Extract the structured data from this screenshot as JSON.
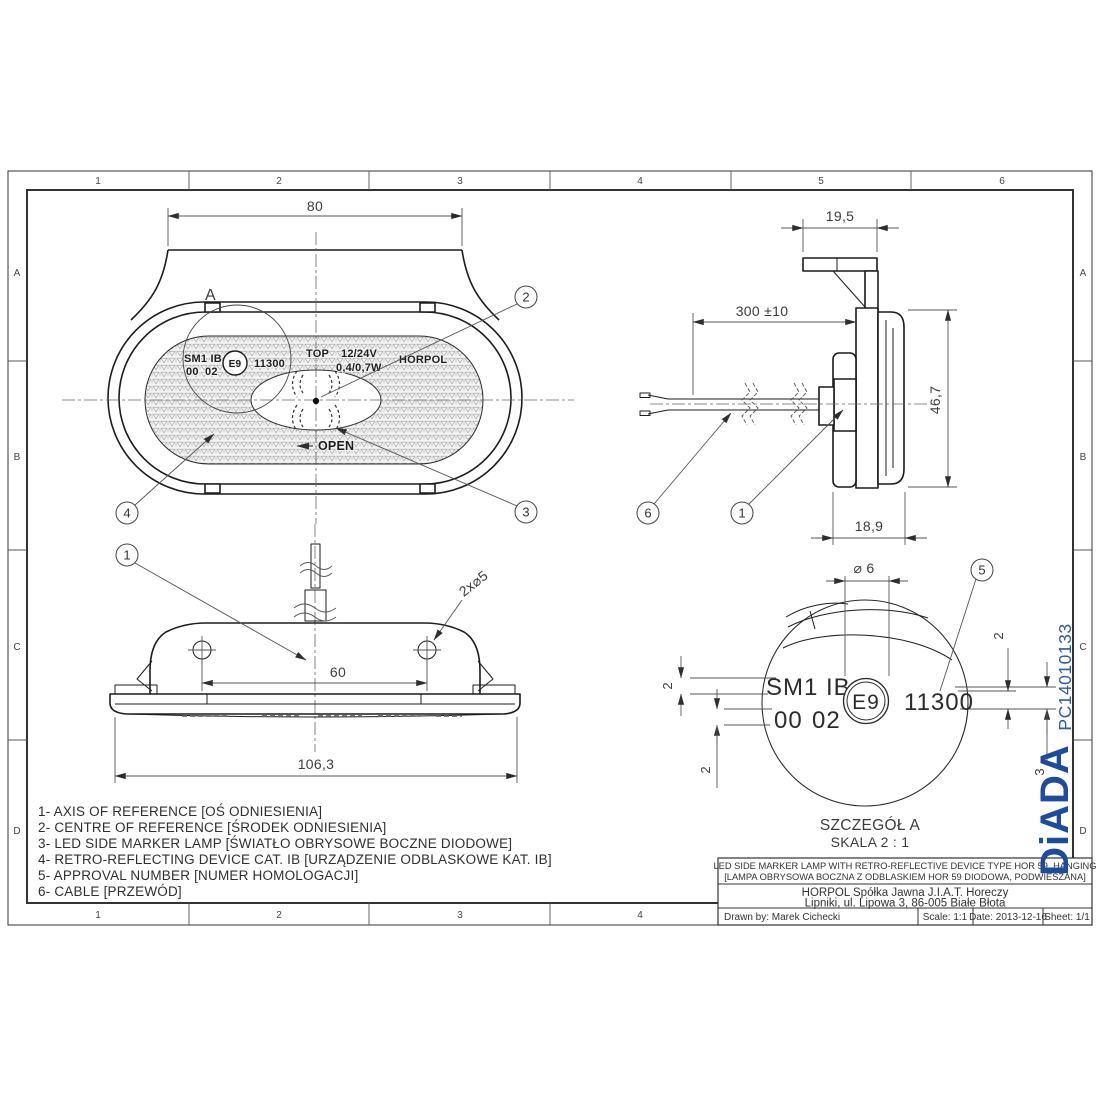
{
  "sheet": {
    "zones_top": [
      "1",
      "2",
      "3",
      "4",
      "5",
      "6"
    ],
    "zones_bottom": [
      "1",
      "2",
      "3",
      "4"
    ],
    "zones_left": [
      "A",
      "B",
      "C",
      "D"
    ],
    "zones_right": [
      "A",
      "B",
      "C",
      "D"
    ],
    "part_code": "PC14010133",
    "watermark": "DiADA"
  },
  "colors": {
    "accent_blue": "#2a5ca8",
    "logo_blue": "#1e4b9e"
  },
  "front": {
    "dim80": "80",
    "detail_mark": "A",
    "face": {
      "model": "SM1 IB",
      "code00": "00",
      "code02": "02",
      "emark": "E9",
      "approval": "11300",
      "top": "TOP",
      "voltage": "12/24V",
      "power": "0,4/0,7W",
      "brand": "HORPOL",
      "open": "OPEN"
    },
    "b2": "2",
    "b3": "3",
    "b4": "4"
  },
  "side": {
    "dim195": "19,5",
    "dim300": "300 ±10",
    "dim467": "46,7",
    "dim189": "18,9",
    "b6": "6",
    "b1": "1"
  },
  "bottom": {
    "dim60": "60",
    "dim1063": "106,3",
    "holes": "2x⌀5",
    "b1": "1"
  },
  "detail": {
    "dia6": "⌀ 6",
    "b5": "5",
    "model": "SM1 IB",
    "code00": "00",
    "code02": "02",
    "emark": "E9",
    "approval": "11300",
    "d2a": "2",
    "d2b": "2",
    "d2c": "2",
    "d3": "3",
    "title": "SZCZEGÓŁ A",
    "scale": "SKALA 2 : 1"
  },
  "legend": {
    "l1": "1- AXIS OF REFERENCE [OŚ ODNIESIENIA]",
    "l2": "2- CENTRE OF REFERENCE [ŚRODEK ODNIESIENIA]",
    "l3": "3- LED SIDE MARKER LAMP [ŚWIATŁO OBRYSOWE BOCZNE DIODOWE]",
    "l4": "4- RETRO-REFLECTING DEVICE CAT. IB [URZĄDZENIE ODBLASKOWE KAT. IB]",
    "l5": "5- APPROVAL NUMBER [NUMER HOMOLOGACJI]",
    "l6": "6- CABLE [PRZEWÓD]"
  },
  "titleblock": {
    "title_en": "LED SIDE MARKER LAMP WITH RETRO-REFLECTIVE DEVICE TYPE HOR 59, HANGING",
    "title_pl": "[LAMPA OBRYSOWA BOCZNA Z ODBLASKIEM HOR 59 DIODOWA, PODWIESZANA]",
    "company1": "HORPOL Spółka Jawna J.I.A.T. Horeczy",
    "company2": "Lipniki, ul. Lipowa 3, 86-005 Białe Błota",
    "drawn": "Drawn by:  Marek Cichecki",
    "scale": "Scale: 1:1",
    "date": "Date: 2013-12-16",
    "sheet": "Sheet: 1/1"
  }
}
